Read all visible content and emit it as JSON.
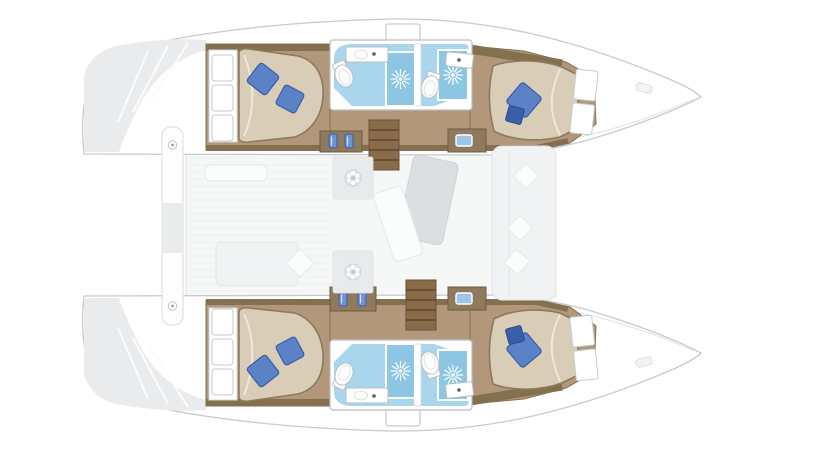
{
  "page": {
    "background": "#ffffff"
  },
  "diagram": {
    "kind": "boat-interior-floorplan-top-view",
    "subject": "sailing-catamaran-with-two-hulls-and-central-bridge-deck",
    "hulls": {
      "port_top": {
        "rooms": [
          "aft-double-cabin",
          "bathroom-with-shower",
          "bathroom-with-shower",
          "forward-double-cabin"
        ]
      },
      "starboard_bottom": {
        "rooms": [
          "aft-double-cabin",
          "bathroom-with-shower",
          "bathroom-with-shower",
          "forward-double-cabin"
        ]
      }
    },
    "bridge_deck": {
      "areas": [
        "aft-cockpit-with-sunpad",
        "salon-with-table-and-sofa",
        "forward-deck"
      ]
    },
    "fixtures": {
      "double_beds": 4,
      "blue_pillows": 6,
      "toilets": 4,
      "shower_cubicles": 4,
      "washbasins": 4,
      "staircases": 2,
      "storage_cabinets": 4,
      "doormats": 2,
      "walkway_planks": 1
    },
    "colors": {
      "hull_outline": "#c6cacd",
      "hull_fill": "#ffffff",
      "stern_shading": "#e9ebed",
      "deck_floor": "#f6f7f7",
      "plank_stripe": "#eef0f1",
      "wood_floor": "#b2977a",
      "wood_wall": "#84704f",
      "stairs": "#8a6c4b",
      "stairs_edge": "#6b523a",
      "stair_tread": "#5f482f",
      "cabinet": "#8f7a5c",
      "cabinet_edge": "#6e5a40",
      "bed_fill": "#d9cdb7",
      "bed_stroke": "#8b7a5e",
      "bed_fold": "#efe8da",
      "mattress_white": "#ffffff",
      "mattress_stroke": "#c6cacd",
      "pillow_blue": "#5b82c6",
      "pillow_blue_dark": "#3a5ea8",
      "bottle_blue": "#6f94d4",
      "screen_blue": "#9fc4ea",
      "bath_floor": "#a9d6ec",
      "shower_blue": "#8cc6e2",
      "fixture_stroke": "#b9bec2",
      "faint_furniture": "#f0f2f3",
      "faint_stroke": "#e2e5e7"
    }
  }
}
